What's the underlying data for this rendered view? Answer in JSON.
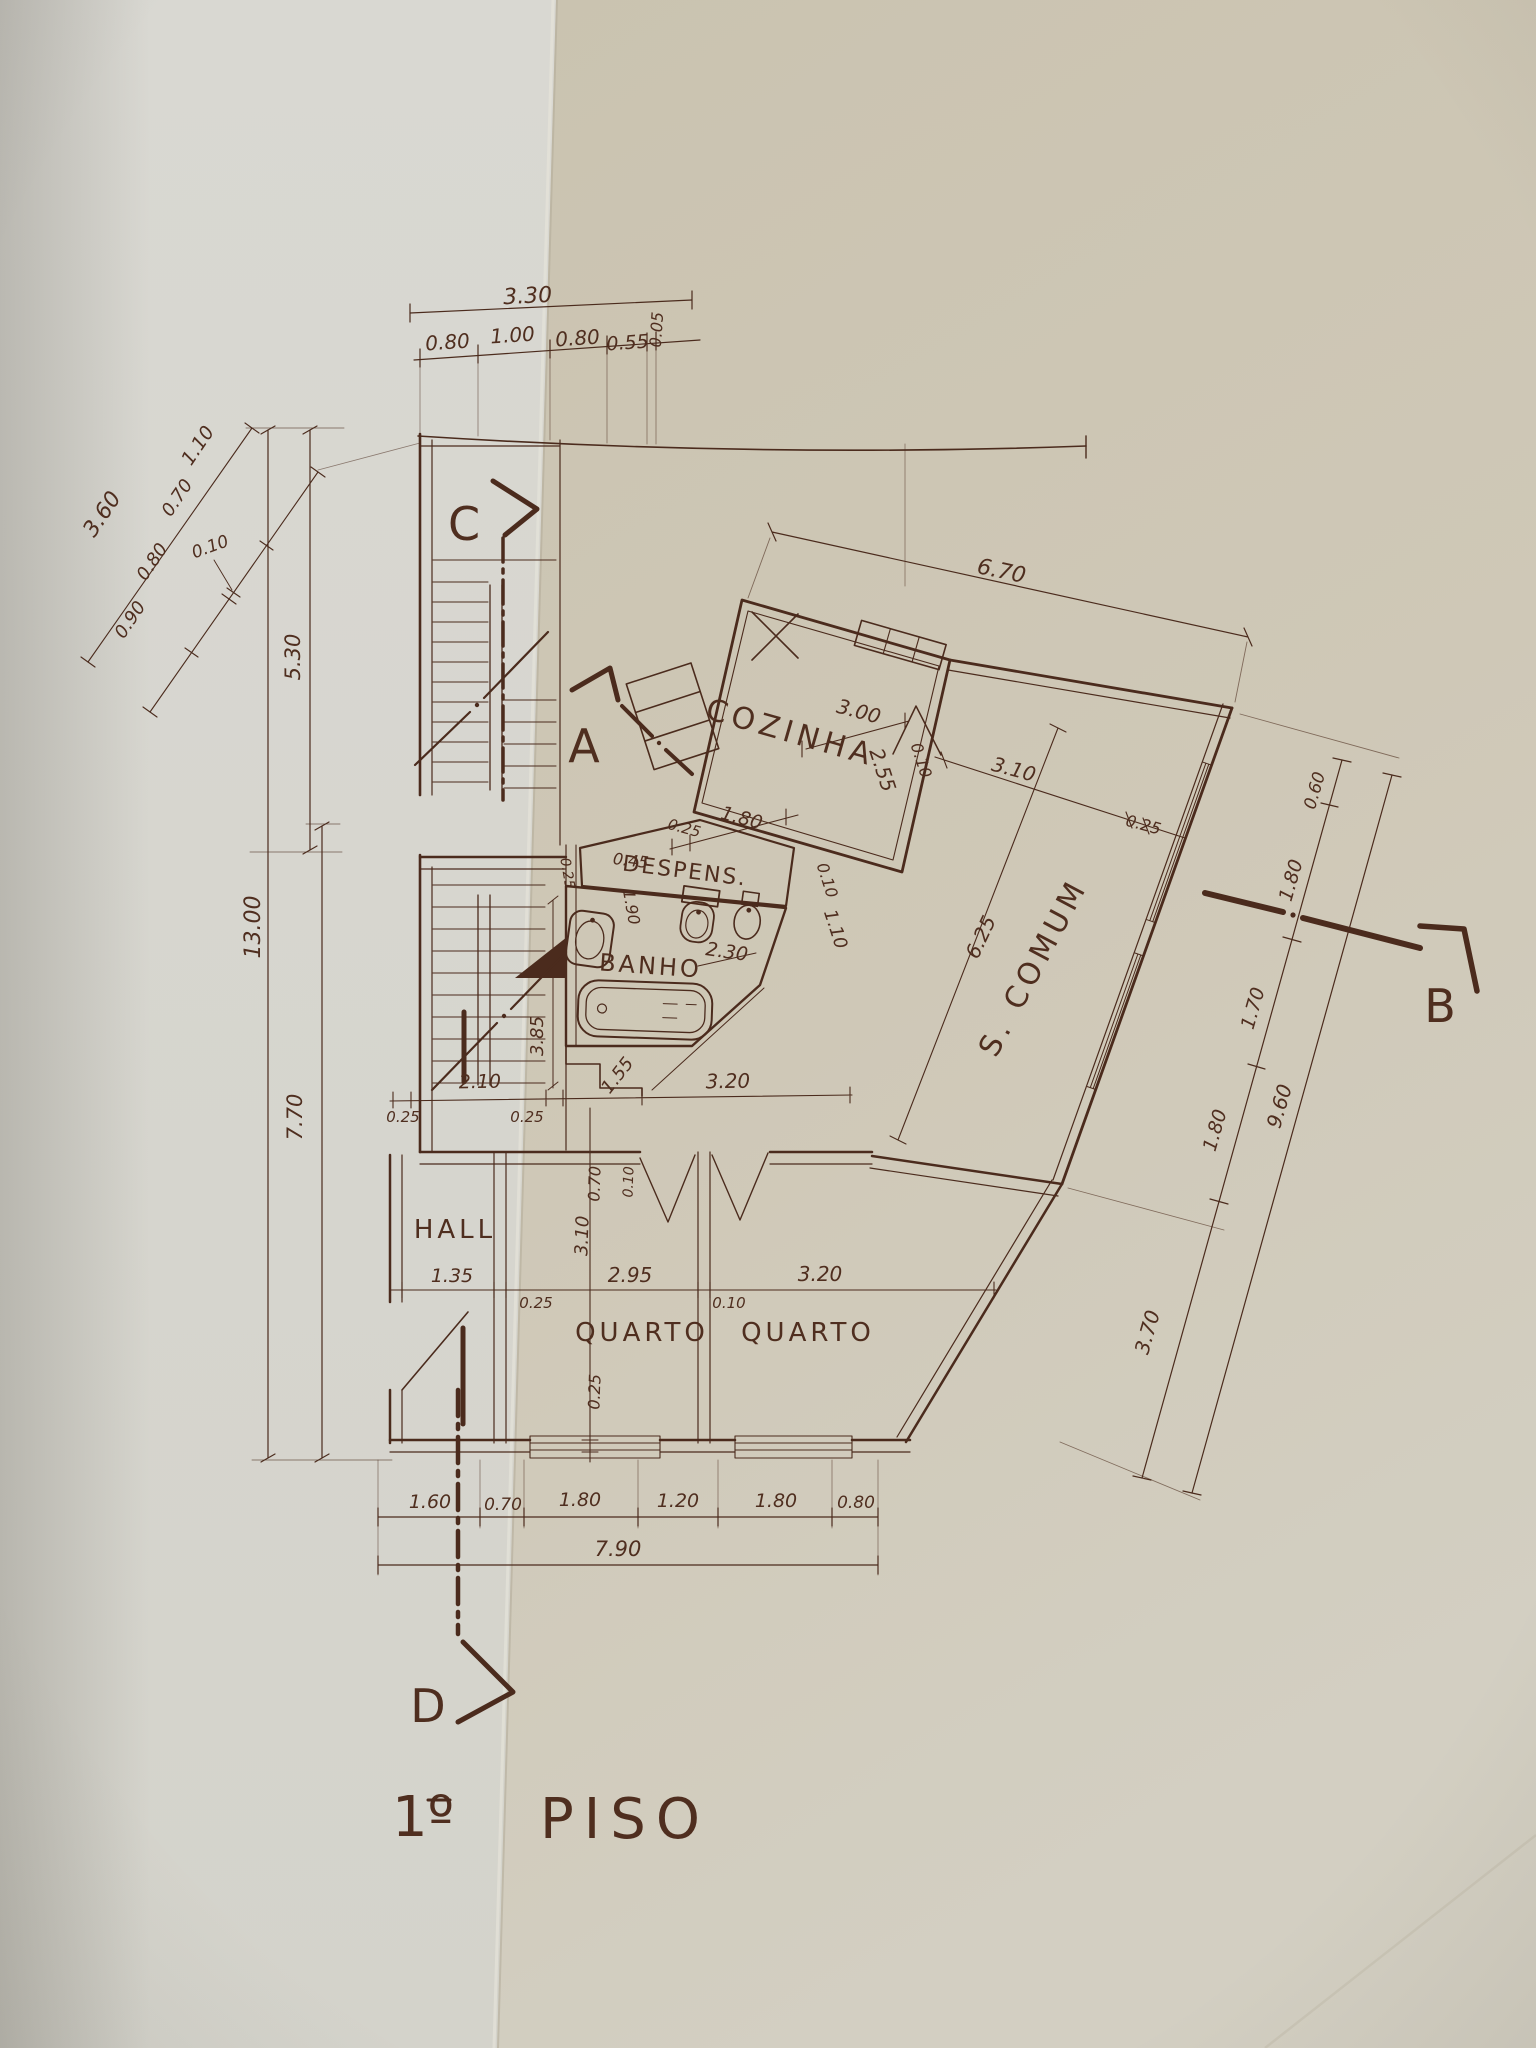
{
  "document": {
    "kind": "architectural floor plan photograph",
    "language": "Portuguese",
    "title": {
      "number": "1º",
      "word": "PISO"
    }
  },
  "palette": {
    "ink": "#4b2b1d",
    "paper_left": "#d8d6cf",
    "paper_right": "#cec7b6",
    "fixture_fill": "#d2ccbc"
  },
  "rooms": {
    "kitchen": "COZINHA",
    "pantry": "DESPENS.",
    "bath": "BANHO",
    "living": "S. COMUM",
    "hall": "HALL",
    "bedroom1": "QUARTO",
    "bedroom2": "QUARTO"
  },
  "sections": {
    "a": "A",
    "b": "B",
    "c": "C",
    "d": "D"
  },
  "dims": {
    "top": {
      "total": "3.30",
      "p1": "0.80",
      "p2": "1.00",
      "p3": "0.80",
      "p4": "0.55",
      "p5": "0.05"
    },
    "left_diag": {
      "total": "3.60",
      "p1": "1.10",
      "p2": "0.70",
      "p3": "0.10",
      "p4": "0.80",
      "p5": "0.90"
    },
    "left": {
      "v1": "5.30",
      "v2": "13.00",
      "v3": "7.70"
    },
    "top_right": {
      "total": "6.70"
    },
    "kitchen": {
      "w": "3.00",
      "d": "2.55",
      "wall": "0.10",
      "n1": "1.80",
      "n2": "0.25"
    },
    "pantry": {
      "n1": "0.45",
      "n2": "1.90",
      "n3": "0.25"
    },
    "bath": {
      "n1": "2.30",
      "n2": "0.10",
      "n3": "1.10",
      "n4": "1.55",
      "n5": "3.85"
    },
    "living": {
      "len": "6.25",
      "w": "3.10",
      "wall": "0.25"
    },
    "right": {
      "p1": "0.60",
      "p2": "1.80",
      "p3": "1.70",
      "p4": "1.80",
      "p5": "3.70",
      "total": "9.60"
    },
    "mid": {
      "p1": "0.25",
      "p2": "2.10",
      "p3": "0.25",
      "p4": "3.20"
    },
    "bed_h": {
      "p1": "1.35",
      "p2": "0.25",
      "p3": "2.95",
      "p4": "0.10",
      "p5": "3.20"
    },
    "bed_v": {
      "p1": "0.70",
      "p2": "0.10",
      "p3": "3.10",
      "p4": "0.25"
    },
    "bottom": {
      "total": "7.90",
      "p1": "1.60",
      "p2": "0.70",
      "p3": "1.80",
      "p4": "1.20",
      "p5": "1.80",
      "p6": "0.80"
    }
  }
}
